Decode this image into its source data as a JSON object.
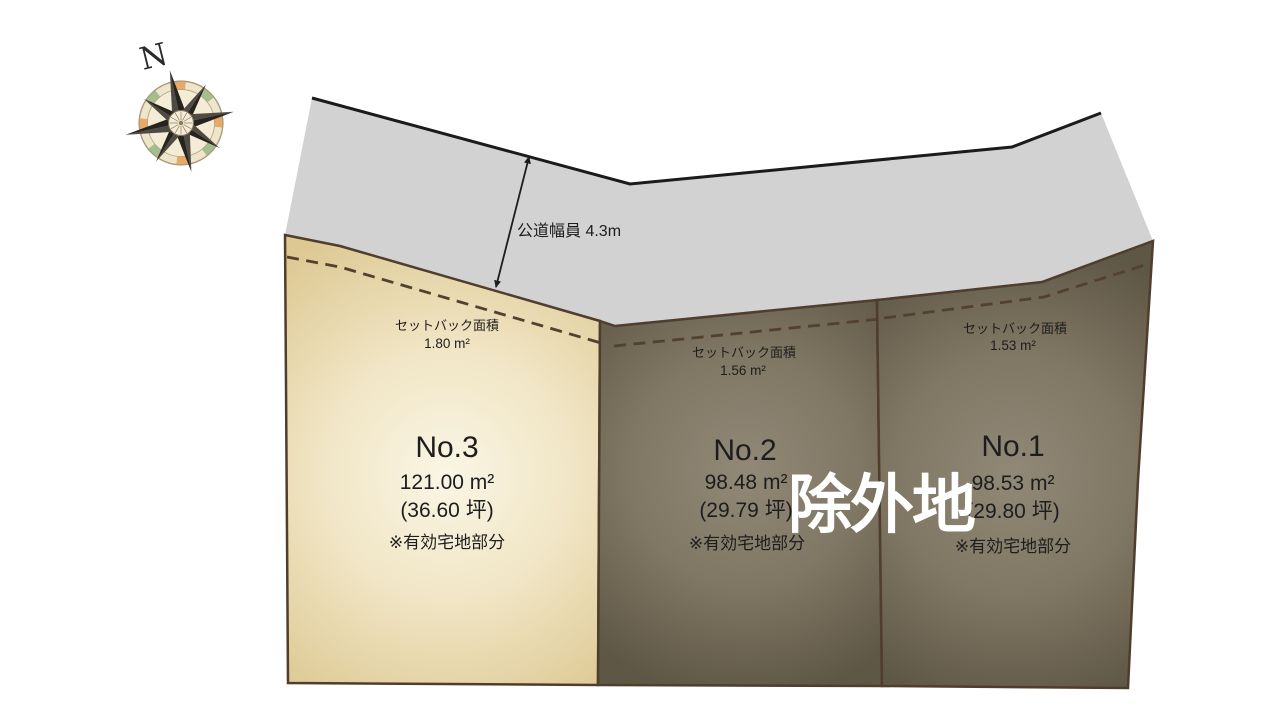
{
  "compass": {
    "north_label": "N"
  },
  "road": {
    "width_label": "公道幅員 4.3m"
  },
  "excluded_area": {
    "label": "除外地"
  },
  "plots": [
    {
      "name": "No.3",
      "area_sqm": "121.00 m²",
      "area_tsubo": "(36.60 坪)",
      "note": "※有効宅地部分",
      "setback_label": "セットバック面積",
      "setback_area": "1.80 m²"
    },
    {
      "name": "No.2",
      "area_sqm": "98.48 m²",
      "area_tsubo": "(29.79 坪)",
      "note": "※有効宅地部分",
      "setback_label": "セットバック面積",
      "setback_area": "1.56 m²"
    },
    {
      "name": "No.1",
      "area_sqm": "98.53 m²",
      "area_tsubo": "(29.80 坪)",
      "note": "※有効宅地部分",
      "setback_label": "セットバック面積",
      "setback_area": "1.53 m²"
    }
  ],
  "colors": {
    "road_fill": "#d2d2d2",
    "road_outer_edge": "#1b1b1b",
    "parcel_border": "#4f3d2e",
    "setback_dashed_line": "#53402f",
    "plot3_fill_center": "#faf5e5",
    "plot3_fill_edge": "#ddc892",
    "dark_plot_fill_center": "#918877",
    "dark_plot_fill_edge": "#5f5745",
    "label_text": "#1d1d1d",
    "excluded_label_text": "#ffffff",
    "compass_face": "#f4ecd6",
    "compass_ring_orange": "#e8a967",
    "compass_ring_green": "#a3bf8c",
    "compass_star_dark": "#272420"
  }
}
